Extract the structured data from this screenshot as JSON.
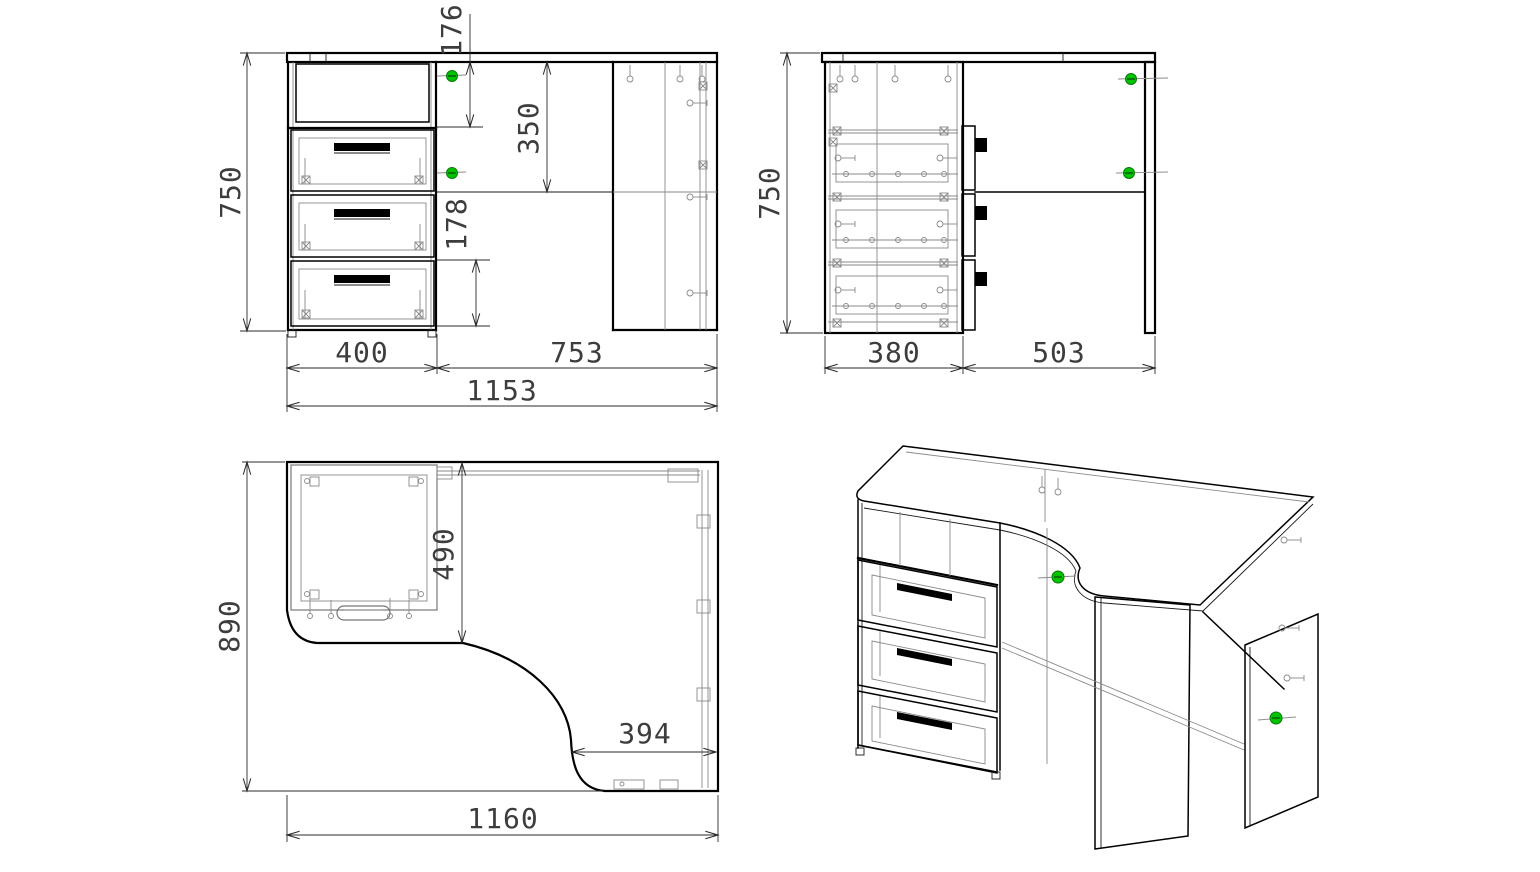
{
  "document": {
    "type": "furniture technical drawing",
    "subject": "corner computer desk with 3-drawer cabinet",
    "background": "#ffffff"
  },
  "colors": {
    "outline": "#000000",
    "detail_gray": "#8a8a8a",
    "dimension_line": "#2b2b2b",
    "dimension_text": "#3d3d3d",
    "fastener_green": "#00c300",
    "handle_black": "#000000"
  },
  "views": {
    "front": {
      "name": "front-view",
      "dims": {
        "height": "750",
        "top_compartment": "176",
        "apron_height": "350",
        "drawer_height": "178",
        "cabinet_width": "400",
        "knee_span": "753",
        "total_width": "1153"
      }
    },
    "side": {
      "name": "side-view",
      "dims": {
        "height": "750",
        "cabinet_depth": "380",
        "knee_span": "503"
      }
    },
    "top": {
      "name": "plan-view",
      "dims": {
        "total_depth": "890",
        "cabinet_zone_depth": "490",
        "side_edge": "394",
        "total_width": "1160"
      }
    },
    "iso": {
      "name": "isometric-view",
      "drawers": 3
    }
  }
}
